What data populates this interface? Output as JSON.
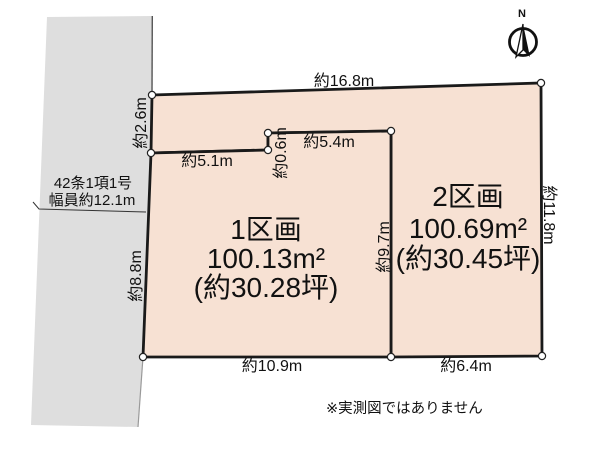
{
  "figure": {
    "note": "※実測図ではありません",
    "compass": {
      "label": "N"
    }
  },
  "road": {
    "label_line1": "42条1項1号",
    "label_line2": "幅員約12.1m",
    "fill": "#dedede"
  },
  "parcels": [
    {
      "name": "1区画",
      "area": "100.13m²",
      "tsubo": "(約30.28坪)",
      "fill": "#f7e1d3"
    },
    {
      "name": "2区画",
      "area": "100.69m²",
      "tsubo": "(約30.45坪)",
      "fill": "#f7e1d3"
    }
  ],
  "dimensions": {
    "top_edge": "約16.8m",
    "road_frontage": "約2.6m",
    "parcel1_top_left": "約5.1m",
    "notch": "約0.6m",
    "parcel1_top_right": "約5.4m",
    "right_edge": "約11.8m",
    "divider": "約9.7m",
    "left_edge": "約8.8m",
    "bottom_left": "約10.9m",
    "bottom_right": "約6.4m"
  },
  "colors": {
    "outline": "#1a1a1a",
    "road_fill": "#dedede",
    "parcel_fill": "#f7e1d3",
    "road_edge_dark": "#555555",
    "road_edge_light": "#9a9a9a"
  }
}
